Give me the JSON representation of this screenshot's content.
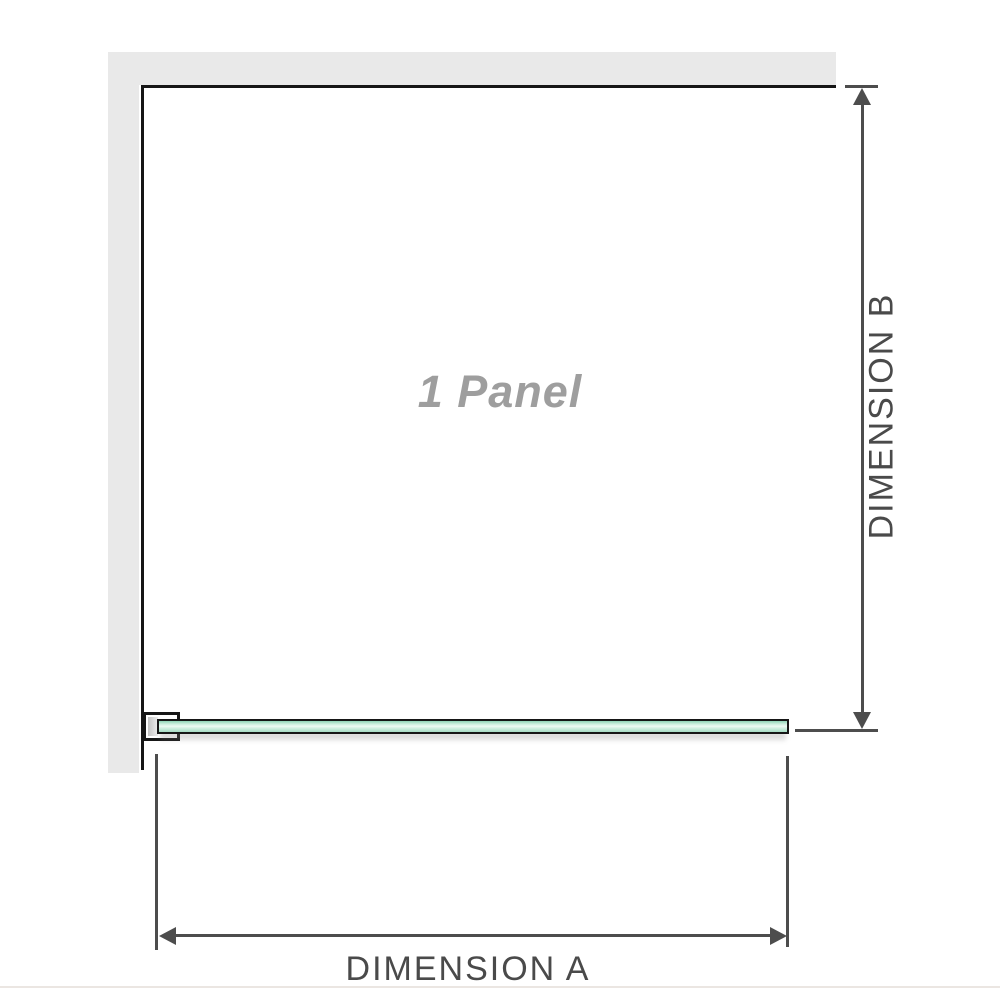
{
  "diagram": {
    "panel_label": "1 Panel",
    "dimension_a_label": "DIMENSION A",
    "dimension_b_label": "DIMENSION B",
    "panel_count": 1,
    "colors": {
      "wall_gray": "#e9e9e9",
      "outline_black": "#161616",
      "dimension_line_gray": "#4d4d4d",
      "dimension_text_gray": "#4a4a4a",
      "panel_label_gray": "#9e9e9e",
      "glass_green_dark": "#8fd2b5",
      "glass_green_light": "#eef9f3"
    }
  }
}
